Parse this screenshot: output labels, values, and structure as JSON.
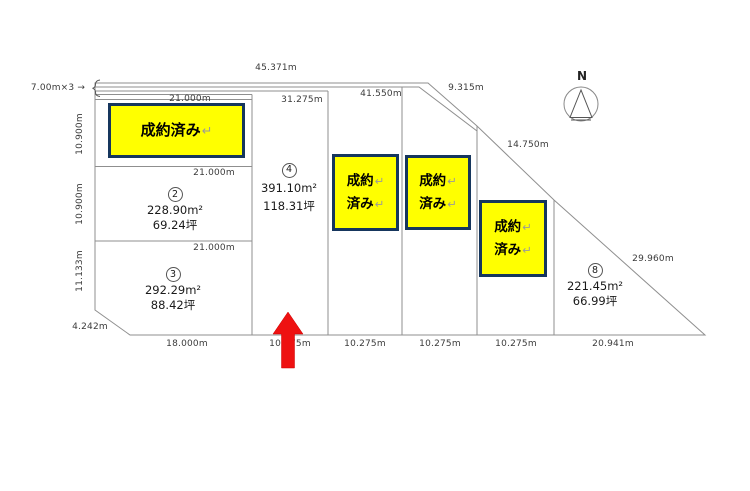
{
  "compass": {
    "north_label": "N"
  },
  "sold_overlays": {
    "wide": {
      "text": "成約済み",
      "return_mark": "↵"
    },
    "small": {
      "line1": "成約",
      "line2": "済み",
      "return_mark": "↵"
    }
  },
  "plots": {
    "plot2": {
      "number": "2",
      "area_sqm": "228.90m²",
      "area_tsubo": "69.24坪"
    },
    "plot3": {
      "number": "3",
      "area_sqm": "292.29m²",
      "area_tsubo": "88.42坪"
    },
    "plot4": {
      "number": "4",
      "area_sqm": "391.10m²",
      "area_tsubo": "118.31坪"
    },
    "plot8": {
      "number": "8",
      "area_sqm": "221.45m²",
      "area_tsubo": "66.99坪"
    }
  },
  "dimensions": {
    "top_total": "45.371m",
    "top_inner": "41.550m",
    "top_mid": "31.275m",
    "plot1_frontage": "21.000m",
    "plot2_frontage": "21.000m",
    "plot3_frontage": "21.000m",
    "diagonal_ne": "9.315m",
    "diagonal_mid": "14.750m",
    "diagonal_se": "29.960m",
    "left_upper": "10.900m",
    "left_middle": "10.900m",
    "left_lower": "11.133m",
    "corner_cut": "4.242m",
    "road_note": "7.00m×3 →",
    "bottom_plot3": "18.000m",
    "bottom_plot4": "10.275m",
    "bottom_plot5": "10.275m",
    "bottom_plot6": "10.275m",
    "bottom_plot7": "10.275m",
    "bottom_plot8": "20.941m"
  },
  "colors": {
    "sold_fill": "#ffff00",
    "sold_border": "#16365d",
    "arrow_red": "#ee1111",
    "line_gray": "#8f8f8f"
  }
}
